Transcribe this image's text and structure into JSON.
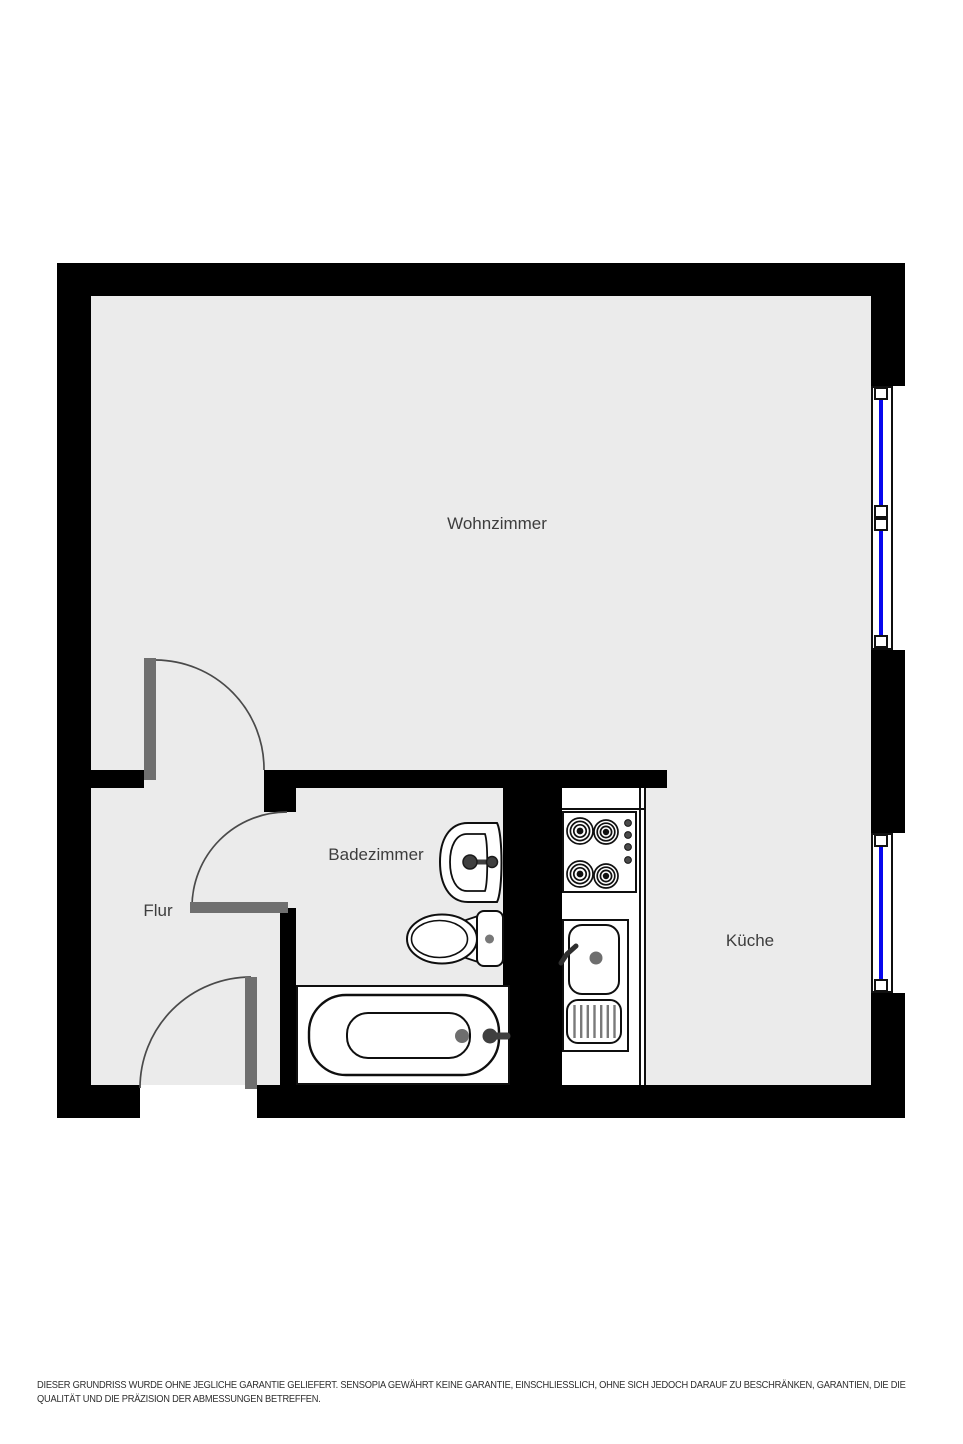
{
  "floorplan": {
    "title": "Grundriss",
    "rooms": [
      {
        "id": "wohnzimmer",
        "label": "Wohnzimmer"
      },
      {
        "id": "badezimmer",
        "label": "Badezimmer"
      },
      {
        "id": "flur",
        "label": "Flur"
      },
      {
        "id": "kueche",
        "label": "Küche"
      }
    ],
    "fixture_icons": [
      "stove-icon",
      "kitchen-sink-icon",
      "washbasin-icon",
      "toilet-icon",
      "bathtub-icon",
      "window-icon",
      "door-swing-icon"
    ],
    "colors": {
      "wall": "#000000",
      "floor": "#ebebeb",
      "door": "#6f6f6f",
      "door_arc": "#4a4a4a",
      "window_glass": "#0707ee",
      "fixture_outline": "#0f0f0f",
      "fixture_metal": "#3f3f3f",
      "label_text": "#3d3d3d",
      "disclaimer_text": "#2e2e2e"
    }
  },
  "disclaimer": {
    "line1": "DIESER GRUNDRISS WURDE OHNE JEGLICHE GARANTIE GELIEFERT. SENSOPIA GEWÄHRT KEINE GARANTIE, EINSCHLIESSLICH, OHNE SICH JEDOCH DARAUF ZU BESCHRÄNKEN, GARANTIEN, DIE DIE",
    "line2": "QUALITÄT UND DIE PRÄZISION DER ABMESSUNGEN BETREFFEN."
  }
}
